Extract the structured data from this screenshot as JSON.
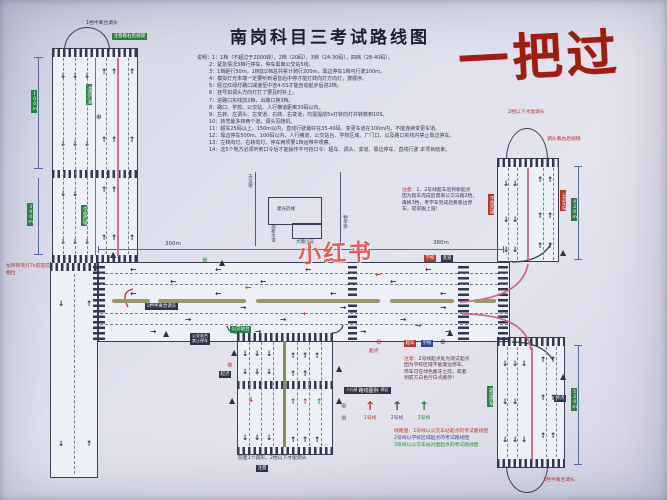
{
  "title": "南岗科目三考试路线图",
  "stamp": "一把过",
  "watermark": "小红书",
  "icons": {
    "arrow_up": "↑",
    "arrow_down": "↓",
    "arrow_left": "←",
    "arrow_right": "→",
    "warning_triangle": "▲",
    "circle_sign": "⊕"
  },
  "colors": {
    "route1": "#c23a2e",
    "route2": "#5a4470",
    "route3": "#2f8a3c",
    "paper": "#e1e2ee",
    "road_line": "#3a3f55",
    "dim_line": "#5a6aa0"
  },
  "notes": {
    "lines": [
      "说明：1：1档（不超过于2000转），2档（20码），3档（24-30码），四档（28-40码）。",
      "2：紧急情况3档行停车，停车需离公交站5线。",
      "3：1档距行50m，1档加2档总共累计骑行200m，靠边停车1档可行驶200m。",
      "4：模拟灯光末端一定要听到语音后中停才能打转向灯方向灯，按顺序。",
      "5：经过红绿灯路口减速至中途4-5S才能自动起步后进2档。",
      "6：挂号如调头方向灯打了要及时补上。",
      "7：进路口实线前2档，出路口换3档。",
      "8：路口、学校、公交站、人行横道距离30码以内。",
      "9：左转、左调头、左变道、右转、右变道，均需提前5s打转向灯并转数到10S。",
      "10：转弯最多转两个道，调头见随机。",
      "11：超车25码以上，150m以内，直线行驶最好在35-40码，变更车道在100m内，不能连续变更车道。",
      "12：靠边停车500m、100码以内，人行横道、公交站台、学校区域、厂门口，以及路口实线内禁止靠边停车。",
      "13：左转向灯、右转向灯，停车两项要1档运带中观察。",
      "14：这5个地方必须听到口令后才能操作不可抢口令：超车、调头、变道、靠边停车、直线行驶 本项目结束。"
    ]
  },
  "dims": {
    "left_top": "100m",
    "left_mid": "340m",
    "mid_left": "300m",
    "mid_right": "380m",
    "right_top": "420m",
    "right_bottom": "520m"
  },
  "labels": {
    "uturn_top_left": "1档半离合调头",
    "mirror_note_top_left": "注意看右后视镜",
    "straight_tag": "直线行驶",
    "school_tag_left": "学校区域",
    "left_turn_note_1": "左转转弯灯7s前提前",
    "left_turn_note_2": "相位",
    "uturn_mid": "1档半离合调头",
    "bus_stop_box_1": "公交站台",
    "bus_stop_box_2": "禁止停车",
    "bus_stop_chip": "公交站台",
    "school_chip": "学校",
    "change_lane_chip": "变道",
    "overtake_chip": "超车",
    "start_label": "起点",
    "end_label": "终点",
    "uturn_top_right_1": "2档以下才能调头",
    "uturn_top_right_2": "调头看右后视镜",
    "school_tag_right": "学校区域",
    "bus_tag_right": "公交车站",
    "pull_over_tag": "靠边停车",
    "uturn_bottom_right": "1档半离合调头",
    "crosswalk_note": "人行横道实线9米禁停区",
    "bottom_caption": "前面1个圆形，2档以下才能调头",
    "bottom_chip": "注意",
    "inset_street_left": "天龙街",
    "inset_street_right": "物华街",
    "inset_building": "建光药械",
    "inset_street_bottom_left": "南新大道",
    "inset_street_bottom": "大顺小号"
  },
  "notice_right": {
    "prefix": "注意：",
    "lines": [
      "1、2号线超车后到新起点",
      "因为超车完成后需离公交马路2档，",
      "再换3档，考学车完成后要靠边停",
      "车，提前跟上道！"
    ]
  },
  "notice_bottom": {
    "prefix": "注意：",
    "lines": [
      "2号线起点处为测试起点",
      "因为学校区域不能靠边停车，",
      "停车可在绿色路牙之前，或者",
      "到前方白色行白点路停！"
    ]
  },
  "legend": {
    "header": "路线图例",
    "items": [
      {
        "label": "1号线",
        "color": "#c23a2e"
      },
      {
        "label": "2号线",
        "color": "#5a4470"
      },
      {
        "label": "3号线",
        "color": "#2f8a3c"
      }
    ],
    "descriptions": [
      {
        "text": "线路图：1号线以公交车站起点的考试路线图",
        "color": "#c23a2e"
      },
      {
        "text": "2号线以学校区域起点的考试路线图",
        "color": "#3a4a8a"
      },
      {
        "text": "3号线以公交车站对面起点的考试路线图",
        "color": "#2f8a3c"
      }
    ]
  }
}
